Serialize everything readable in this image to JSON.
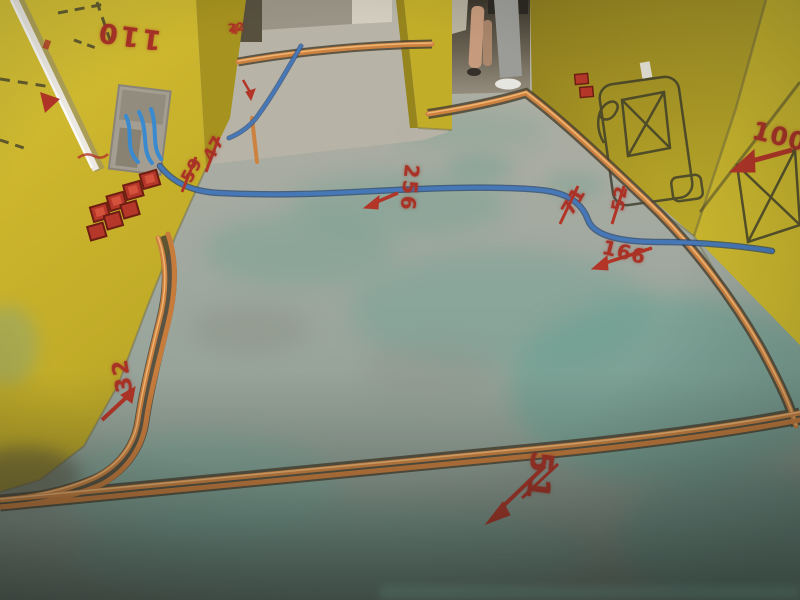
{
  "scene": {
    "kind": "construction-site-photo",
    "subject": "room with rough-in electrical conduits on concrete floor and spray-painted measurements on yellow walls"
  },
  "markings": {
    "m110": "110",
    "m59": "59",
    "m47": "47",
    "m22": "22",
    "m256": "256",
    "m71": "71",
    "m52": "52",
    "m166": "166",
    "m100": "100",
    "m51": "51",
    "m32": "32"
  },
  "palette": {
    "wall_yellow": "#c9b42c",
    "wall_olive": "#a89626",
    "floor_gray": "#a6aaa0",
    "floor_teal": "#7fa89a",
    "conduit_orange": "#cd8240",
    "conduit_blue": "#3f6fae",
    "spray_red": "#b23527",
    "pipe_white": "#ece9e2",
    "outlet_box_red": "#b5372a"
  },
  "objects": {
    "left_wall": "yellow-wall",
    "right_wall": "yellow-wall",
    "niche": "wall-opening-with-blue-flex-conduit",
    "outlet_boxes": "red-junction-boxes",
    "floor": "concrete-floor-with-green-curing-stains",
    "orange_conduit": "floor-chased-orange-conduit",
    "blue_conduit": "floor-blue-conduit",
    "white_pipe": "wall-white-pipe",
    "person": "worker-in-doorway"
  }
}
